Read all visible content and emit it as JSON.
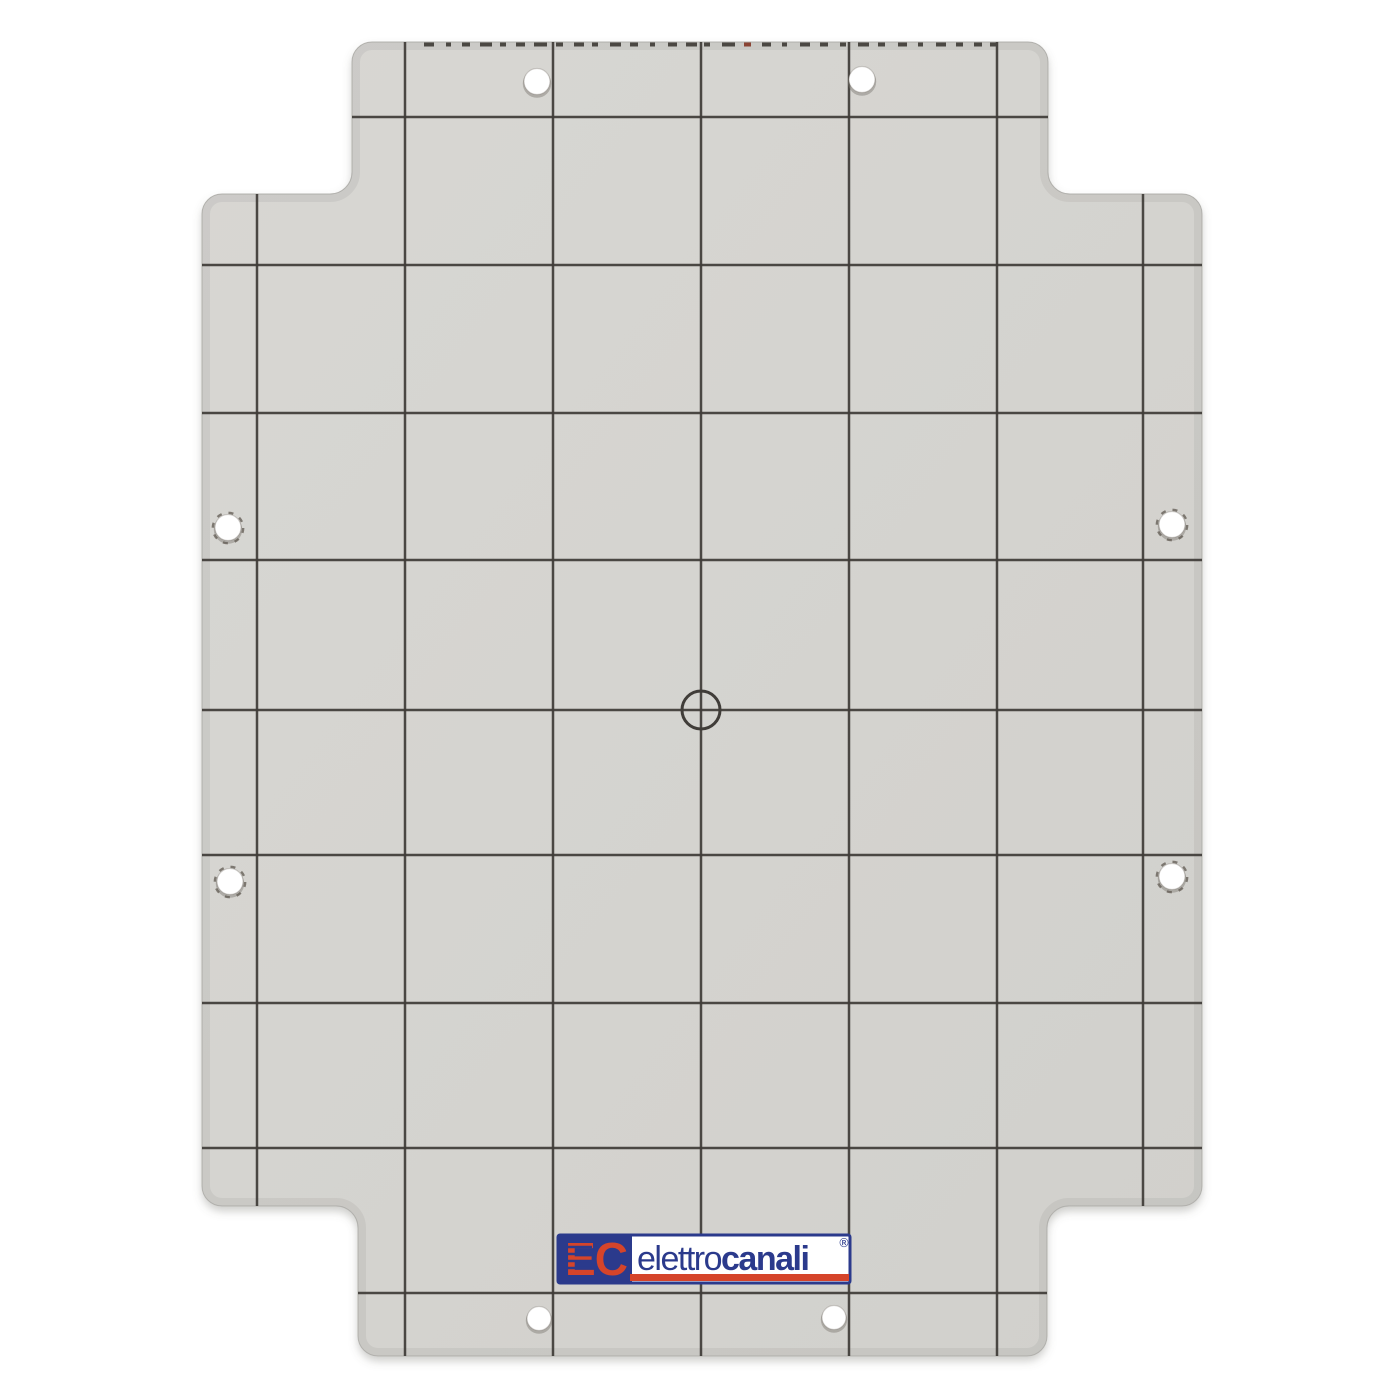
{
  "scene": {
    "description": "Product photograph of a light gray enclosure mounting back-plate printed with a dark reference grid, eight drilled mounting holes, a central drill target and the elettrocanali brand label near the bottom edge",
    "background_color": "#ffffff"
  },
  "plate": {
    "fill_color_light": "#d8d7d3",
    "fill_color_dark": "#d1d0cc",
    "edge_color": "#b7b6b2",
    "grid_color": "#403d39",
    "outline": {
      "top_tab": {
        "left": 352,
        "right": 1048,
        "top": 42
      },
      "body": {
        "left": 202,
        "right": 1202,
        "top": 194,
        "bottom": 1206
      },
      "bottom_tab": {
        "left": 358,
        "right": 1047,
        "bottom": 1356
      },
      "outer_radius": 20,
      "inner_radius": 22
    },
    "grid": {
      "vertical_x": [
        257,
        405,
        553,
        701,
        849,
        997,
        1143
      ],
      "horizontal_y": [
        117,
        265,
        413,
        560,
        710,
        855,
        1003,
        1148,
        1293
      ]
    },
    "center_target": {
      "cx": 701,
      "cy": 710,
      "radius": 19
    },
    "holes": [
      {
        "id": "hole-top-left",
        "cx": 537,
        "cy": 82,
        "r": 13,
        "ragged": false
      },
      {
        "id": "hole-top-right",
        "cx": 862,
        "cy": 80,
        "r": 13,
        "ragged": false
      },
      {
        "id": "hole-left-upper",
        "cx": 228,
        "cy": 528,
        "r": 13,
        "ragged": true
      },
      {
        "id": "hole-right-upper",
        "cx": 1172,
        "cy": 525,
        "r": 13,
        "ragged": true
      },
      {
        "id": "hole-left-lower",
        "cx": 230,
        "cy": 882,
        "r": 13,
        "ragged": true
      },
      {
        "id": "hole-right-lower",
        "cx": 1172,
        "cy": 877,
        "r": 13,
        "ragged": true
      },
      {
        "id": "hole-bottom-left",
        "cx": 539,
        "cy": 1319,
        "r": 12,
        "ragged": false
      },
      {
        "id": "hole-bottom-right",
        "cx": 834,
        "cy": 1318,
        "r": 12,
        "ragged": false
      }
    ],
    "top_edge_marks": {
      "y": 42.5,
      "height": 4,
      "color": "#4b4843",
      "rust_color": "#8a4434",
      "segments": [
        [
          424,
          10
        ],
        [
          446,
          5
        ],
        [
          462,
          8
        ],
        [
          480,
          12
        ],
        [
          500,
          6
        ],
        [
          516,
          9
        ],
        [
          534,
          13
        ],
        [
          556,
          7
        ],
        [
          574,
          10
        ],
        [
          592,
          6
        ],
        [
          610,
          11
        ],
        [
          630,
          8
        ],
        [
          650,
          5
        ],
        [
          668,
          9
        ],
        [
          686,
          11
        ],
        [
          704,
          6
        ],
        [
          722,
          13
        ],
        [
          744,
          7,
          "rust"
        ],
        [
          762,
          9
        ],
        [
          782,
          5
        ],
        [
          800,
          10
        ],
        [
          820,
          8
        ],
        [
          840,
          6
        ],
        [
          858,
          11
        ],
        [
          878,
          7
        ],
        [
          898,
          9
        ],
        [
          918,
          5
        ],
        [
          936,
          10
        ],
        [
          956,
          7
        ],
        [
          974,
          8
        ],
        [
          990,
          6
        ]
      ]
    }
  },
  "logo": {
    "monogram": "EC",
    "name_regular": "elettro",
    "name_bold": "canali",
    "registered": "®",
    "blue": "#2b3a8c",
    "red": "#d5442a",
    "box": {
      "x": 558,
      "y": 1235,
      "width": 292,
      "height": 48,
      "square_width": 74
    },
    "underline": {
      "x": 630,
      "y": 1274,
      "width": 219,
      "height": 7
    }
  }
}
